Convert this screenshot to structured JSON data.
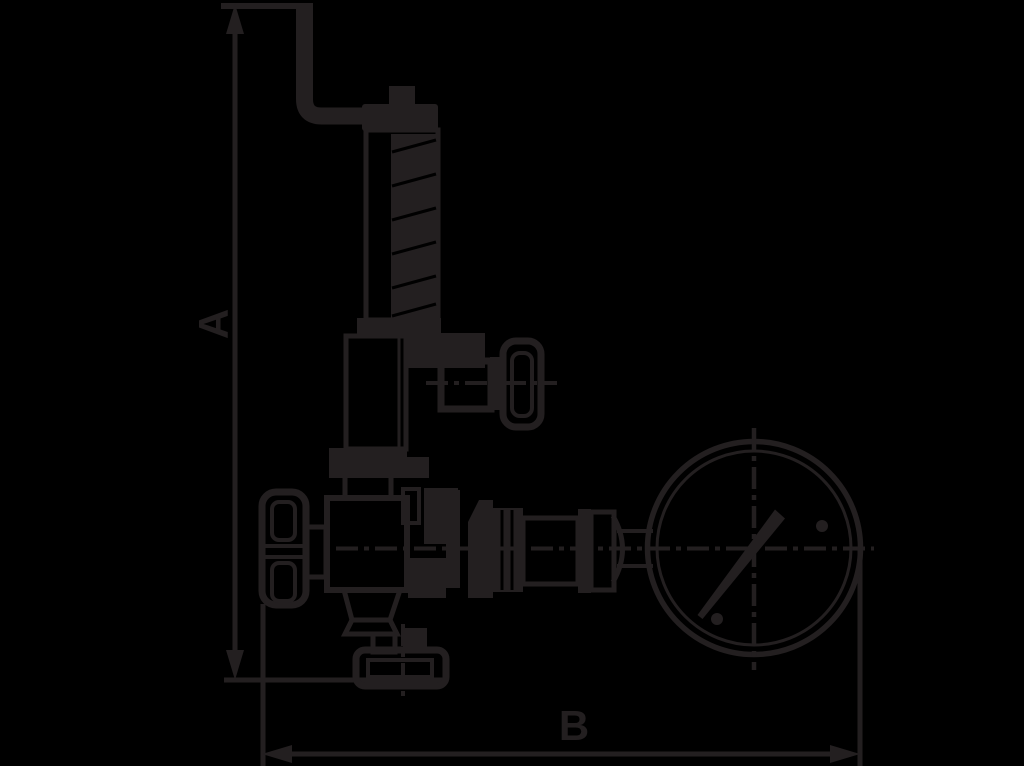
{
  "page": {
    "background_color": "#000000",
    "ink_color": "#231f20"
  },
  "drawing": {
    "kind": "relief-valve-with-pressure-gauge-dimension-drawing",
    "dimensions": [
      {
        "label": "A",
        "orientation": "vertical"
      },
      {
        "label": "B",
        "orientation": "horizontal"
      }
    ]
  }
}
